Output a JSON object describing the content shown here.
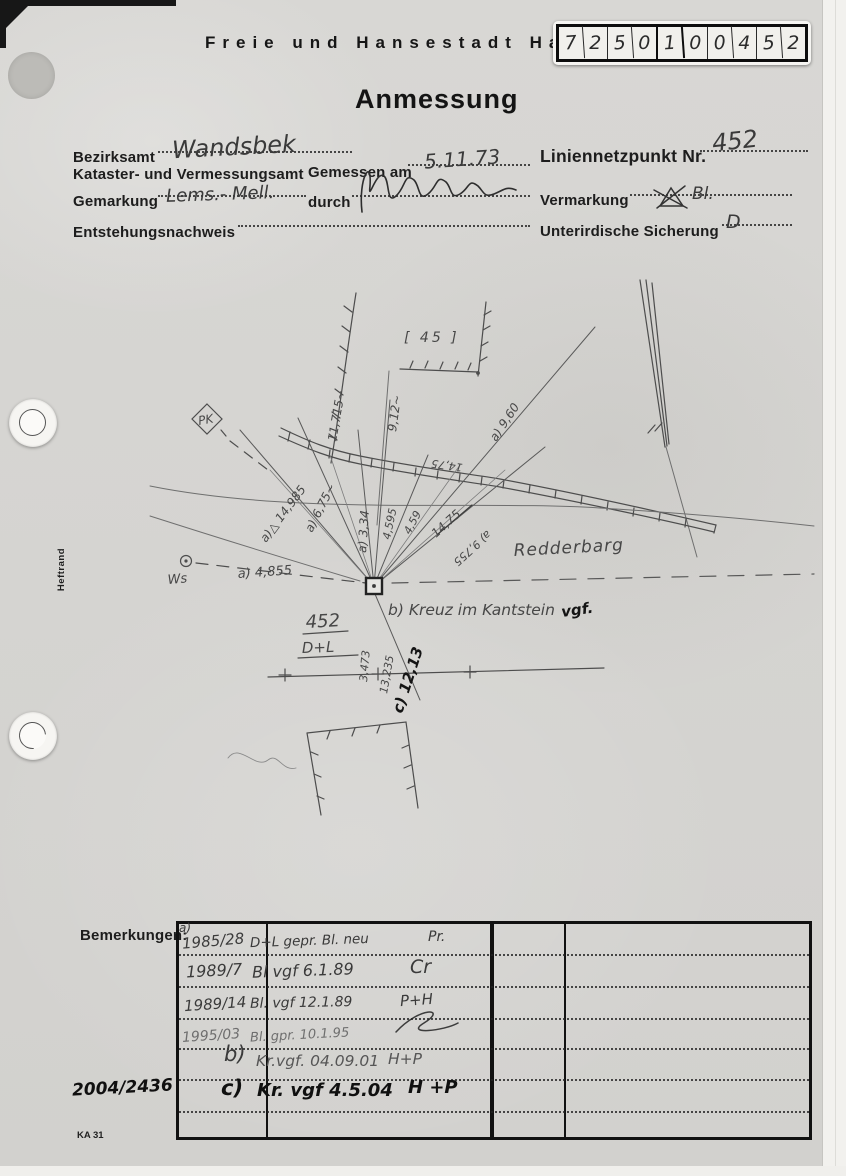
{
  "colors": {
    "paper": "#d6d5d2",
    "pencil": "#474747",
    "ink": "#101010",
    "printed": "#1d1d1d"
  },
  "page": {
    "header_title": "Freie und Hansestadt Ha",
    "doc_title": "Anmessung",
    "margin_label": "Heftrand",
    "form_code": "KA 31",
    "file_number": "2004/2436"
  },
  "stamp": {
    "digits": [
      "7",
      "2",
      "5",
      "0",
      "1",
      "0",
      "0",
      "4",
      "5",
      "2"
    ]
  },
  "form": {
    "bezirksamt_label": "Bezirksamt",
    "bezirksamt_value": "Wandsbek",
    "amt_label": "Kataster- und Vermessungsamt",
    "gemessen_label": "Gemessen am",
    "gemessen_value": "5.11.73",
    "gemarkung_label": "Gemarkung",
    "gemarkung_value": "Lems.- Mell.",
    "durch_label": "durch",
    "entstehung_label": "Entstehungsnachweis",
    "liniennetzpunkt_label": "Liniennetzpunkt Nr.",
    "liniennetzpunkt_value": "452",
    "vermarkung_label": "Vermarkung",
    "vermarkung_value": "Bl.",
    "sicherung_label": "Unterirdische Sicherung",
    "sicherung_value": "D"
  },
  "sketch": {
    "parcel_number": "[ 45 ]",
    "pk_label": "PK",
    "street_name": "Redderbarg",
    "point_number": "452",
    "point_marking": "D+L",
    "point_note": "b) Kreuz im Kantstein",
    "point_note_suffix": "vgf.",
    "ws_label": "Ws",
    "measurements": {
      "m1_11715": "11,715~",
      "m2_912": "9,12~",
      "m3_960": "a) 9,60",
      "m4_1475": "14,75",
      "m5_14985": "a)△ 14,985",
      "m6_675": "a) 6,75~",
      "m7_334": "a) 3,34",
      "m8_4595": "4,595",
      "m9_459": "4,59",
      "m10_1475x": "14,75",
      "m11_9755": "a) 9,755",
      "m12_4855": "a) 4,855",
      "m13_3473": "3,473",
      "m14_13235": "13,235",
      "m15_c1213": "c) 12,13"
    }
  },
  "remarks": {
    "label": "Bemerkungen:",
    "rows": [
      {
        "tag": "a)",
        "ref": "1985/28",
        "note": "D+L gepr. Bl. neu",
        "sign": "Pr."
      },
      {
        "ref": "1989/7",
        "note": "Bl vgf 6.1.89",
        "sign": "Cr"
      },
      {
        "ref": "1989/14",
        "note": "Bl. vgf 12.1.89",
        "sign": "P+H"
      },
      {
        "ref": "1995/03",
        "note": "Bl. gpr. 10.1.95",
        "sign": ""
      },
      {
        "ref": "b)",
        "note": "Kr.vgf. 04.09.01",
        "sign": "H+P"
      },
      {
        "ref": "c)",
        "note": "Kr. vgf 4.5.04",
        "sign": "H +P"
      }
    ]
  }
}
